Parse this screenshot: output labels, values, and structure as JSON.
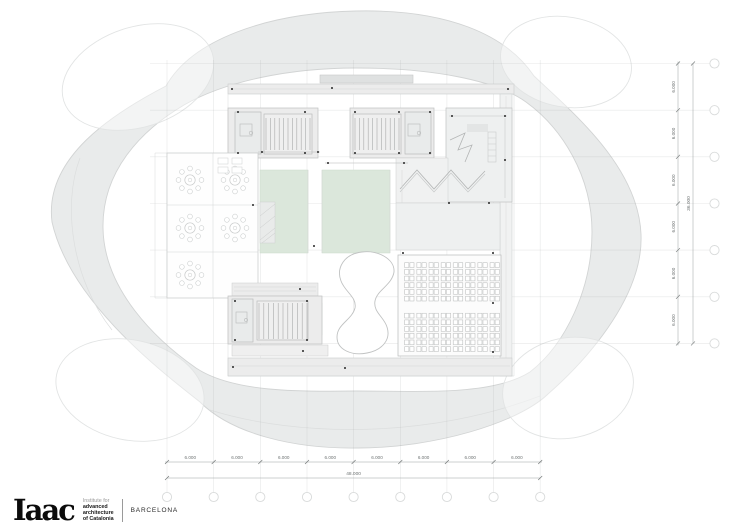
{
  "document": {
    "kind": "architectural floor plan",
    "studio_city": "BARCELONA"
  },
  "logo": {
    "wordmark": "Iaac",
    "tagline_line1": "Institute for",
    "tagline_line2": "advanced",
    "tagline_line3": "architecture",
    "tagline_line4": "of Catalonia",
    "city": "BARCELONA"
  },
  "dimensions": {
    "bottom": {
      "segments": [
        "6.000",
        "6.000",
        "6.000",
        "6.000",
        "6.000",
        "6.000",
        "6.000",
        "6.000"
      ],
      "total": "48.000"
    },
    "right": {
      "segments": [
        "6.000",
        "6.000",
        "6.000",
        "6.000",
        "6.000",
        "6.000"
      ],
      "total": "36.000"
    }
  },
  "palette": {
    "canopy": "#e9ebeb",
    "canopy_edge": "#d2d4d4",
    "room_fill": "#eef0f0",
    "core_fill": "#e9ebeb",
    "line": "#c6c8c8",
    "stair_line": "#a8aaaa",
    "courtyard_green": "#dbe7db",
    "marker_black": "#2f2f2f",
    "dimension_line": "#9aa0a0"
  }
}
